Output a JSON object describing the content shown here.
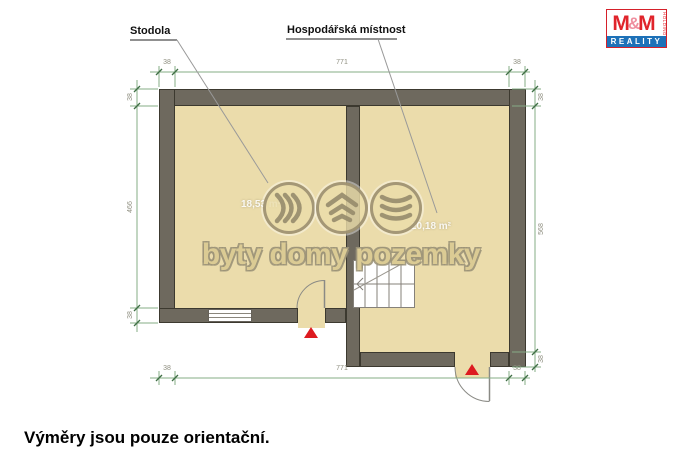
{
  "plan": {
    "rooms": [
      {
        "name": "Stodola",
        "area": "18,53 m²"
      },
      {
        "name": "Hospodářská místnost",
        "area": "20,18 m²"
      }
    ],
    "dimensions": {
      "top": [
        "38",
        "771",
        "38"
      ],
      "bottom": [
        "38",
        "771",
        "38"
      ],
      "left": [
        "38",
        "466",
        "38"
      ],
      "right": [
        "38",
        "568",
        "38"
      ]
    },
    "colors": {
      "floor": "#ebdcab",
      "wall": "#6e695e",
      "wall_outline": "#3c392f",
      "dimension_line": "#86ac86",
      "dimension_text": "#8f8f80",
      "entrance_marker": "#dd1b20"
    }
  },
  "watermark": {
    "text": "byty domy pozemky",
    "color": "#9c9378",
    "icons": [
      "waves-right-icon",
      "roof-chevrons-icon",
      "waves-down-icon"
    ]
  },
  "logo": {
    "m1": "M",
    "amp": "&",
    "m2": "M",
    "holding": "HOLDING",
    "reality": "REALITY",
    "colors": {
      "red": "#e0242b",
      "pink": "#ef8f9f",
      "blue": "#1d71b8"
    }
  },
  "footer": {
    "note": "Výměry jsou pouze orientační."
  }
}
